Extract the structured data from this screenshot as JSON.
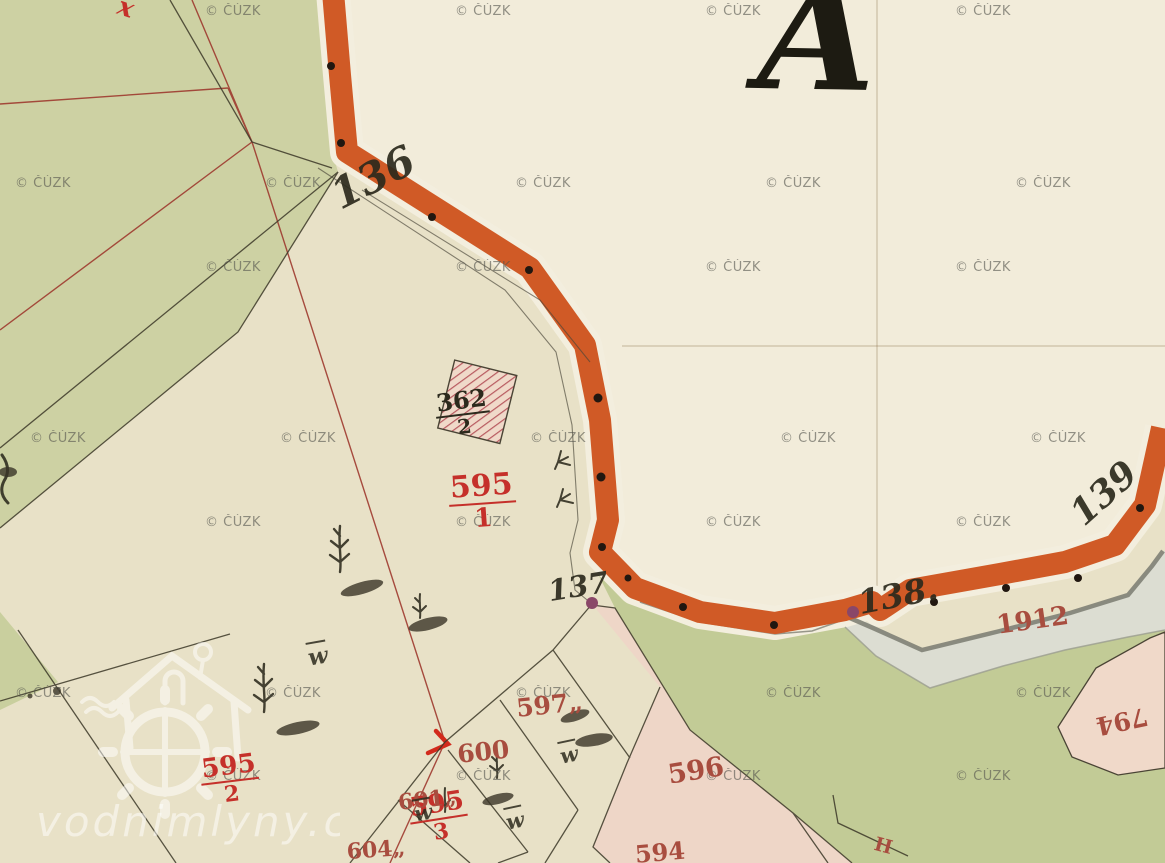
{
  "big_letter": {
    "text": "A"
  },
  "branding": {
    "text": "vodnimlyny.cz"
  },
  "copyright_watermark": {
    "text": "© ČÚZK",
    "rows": [
      {
        "y": 4,
        "xs": [
          205,
          455,
          705,
          955
        ]
      },
      {
        "y": 176,
        "xs": [
          15,
          265,
          515,
          765,
          1015
        ]
      },
      {
        "y": 260,
        "xs": [
          205,
          455,
          705,
          955
        ]
      },
      {
        "y": 431,
        "xs": [
          30,
          280,
          530,
          780,
          1030
        ]
      },
      {
        "y": 515,
        "xs": [
          205,
          455,
          705,
          955
        ]
      },
      {
        "y": 686,
        "xs": [
          15,
          265,
          515,
          765,
          1015
        ]
      },
      {
        "y": 769,
        "xs": [
          205,
          455,
          705,
          955
        ]
      }
    ]
  },
  "parcel_labels": [
    {
      "id": "595-1",
      "type": "fraction",
      "num": "595",
      "den": "1",
      "color": "crimson",
      "x": 447,
      "y": 474,
      "size": 30,
      "rot": -4
    },
    {
      "id": "595-2",
      "type": "fraction",
      "num": "595",
      "den": "2",
      "color": "crimson",
      "x": 198,
      "y": 757,
      "size": 26,
      "rot": -7
    },
    {
      "id": "595-3",
      "type": "fraction",
      "num": "595",
      "den": "3",
      "color": "crimson",
      "x": 406,
      "y": 796,
      "size": 26,
      "rot": -9
    },
    {
      "id": "362-2",
      "type": "fraction",
      "num": "362",
      "den": "2",
      "color": "ink",
      "x": 433,
      "y": 392,
      "size": 24,
      "rot": -7
    },
    {
      "id": "597",
      "type": "plain",
      "text": "597„",
      "color": "brick",
      "x": 515,
      "y": 696,
      "size": 25,
      "rot": -6
    },
    {
      "id": "600",
      "type": "plain",
      "text": "600",
      "color": "brick",
      "x": 456,
      "y": 742,
      "size": 25,
      "rot": -6
    },
    {
      "id": "601",
      "type": "plain",
      "text": "601„",
      "color": "brick",
      "x": 397,
      "y": 792,
      "size": 22,
      "rot": -6
    },
    {
      "id": "604",
      "type": "plain",
      "text": "604„",
      "color": "brick",
      "x": 346,
      "y": 841,
      "size": 22,
      "rot": -4
    },
    {
      "id": "596",
      "type": "plain",
      "text": "596",
      "color": "brick",
      "x": 666,
      "y": 762,
      "size": 27,
      "rot": -9
    },
    {
      "id": "594",
      "type": "plain",
      "text": "594",
      "color": "brick",
      "x": 634,
      "y": 843,
      "size": 24,
      "rot": -5
    },
    {
      "id": "1912",
      "type": "plain",
      "text": "1912",
      "color": "brick",
      "x": 995,
      "y": 613,
      "size": 26,
      "rot": -8
    },
    {
      "id": "794",
      "type": "plain",
      "text": "794",
      "color": "brick",
      "x": 1150,
      "y": 728,
      "size": 25,
      "rot": 168
    },
    {
      "id": "boundary-H",
      "type": "plain",
      "text": "H",
      "color": "brick",
      "x": 877,
      "y": 835,
      "size": 19,
      "rot": 15
    }
  ],
  "ink_numbers": [
    {
      "id": "136",
      "text": "136",
      "x": 345,
      "y": 212,
      "size": 42,
      "rot": -27
    },
    {
      "id": "137",
      "text": "137",
      "x": 551,
      "y": 603,
      "size": 29,
      "rot": -9
    },
    {
      "id": "138",
      "text": "138.",
      "x": 862,
      "y": 616,
      "size": 33,
      "rot": -11
    },
    {
      "id": "139",
      "text": "139",
      "x": 1090,
      "y": 528,
      "size": 36,
      "rot": -42
    }
  ],
  "w_symbols": [
    {
      "x": 308,
      "y": 643,
      "size": 23,
      "rot": -10
    },
    {
      "x": 560,
      "y": 742,
      "size": 21,
      "rot": -12
    },
    {
      "x": 414,
      "y": 800,
      "size": 21,
      "rot": -10
    },
    {
      "x": 506,
      "y": 808,
      "size": 21,
      "rot": -12
    }
  ],
  "red_x_mark": {
    "text": "x",
    "x": 118,
    "y": -7,
    "size": 26,
    "rot": 18
  },
  "colors": {
    "paper": "#e8e1c7",
    "white-region": "#f2ecda",
    "green1": "#cdd1a3",
    "green2": "#c2cb96",
    "green3": "#c9cf9e",
    "orange": "#d05a26",
    "margin": "#f3eede",
    "gray-band": "#dcddd2",
    "gray-edge": "#7f8176",
    "pink": "#eed6c7",
    "pink2": "#f0d9c9",
    "ink": "#2c2a1d",
    "crimson": "#c5302a",
    "brick": "#a84d3f",
    "redline": "#9e3a2f",
    "bright-red": "#d22a1c",
    "purple": "#8a4768",
    "hatch-red": "#b85a60",
    "wm": "#56564f"
  }
}
